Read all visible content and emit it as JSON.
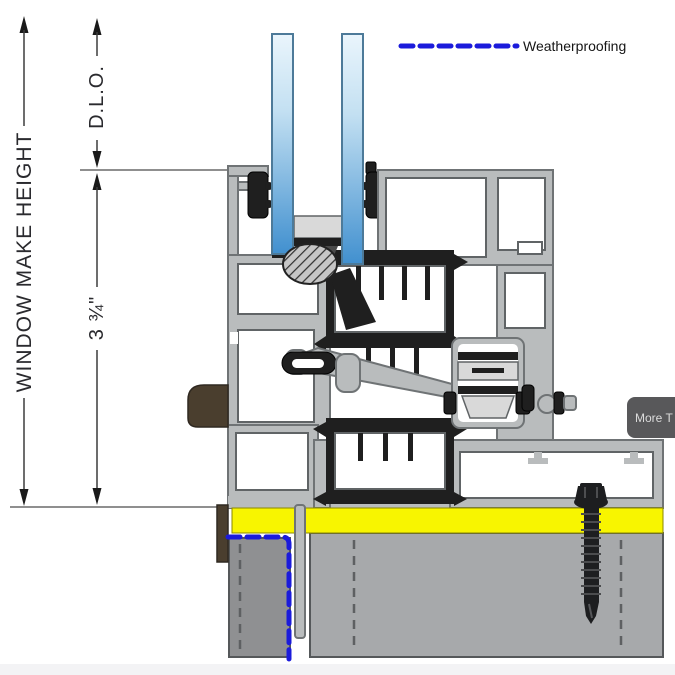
{
  "annotations": {
    "window_make_height_label": "WINDOW MAKE HEIGHT",
    "dlo_label": "D.L.O.",
    "frame_dim_label": "3 ¾\""
  },
  "legend": {
    "weatherproofing_label": "Weatherproofing"
  },
  "overlay": {
    "more_button_label": "More T"
  },
  "colors": {
    "weatherproofing_blue": "#1b1bdb",
    "glass_blue": "#4190cf",
    "aluminum_gray": "#b9bcbd",
    "aluminum_outline": "#6f7375",
    "thermal_break_black": "#1f1f1f",
    "shim_yellow": "#f8f500",
    "concrete_gray": "#a7a9ab",
    "concrete_dark_gray": "#8f9092",
    "sealant_brown": "#4a3e2e",
    "button_gray": "#58585a"
  }
}
